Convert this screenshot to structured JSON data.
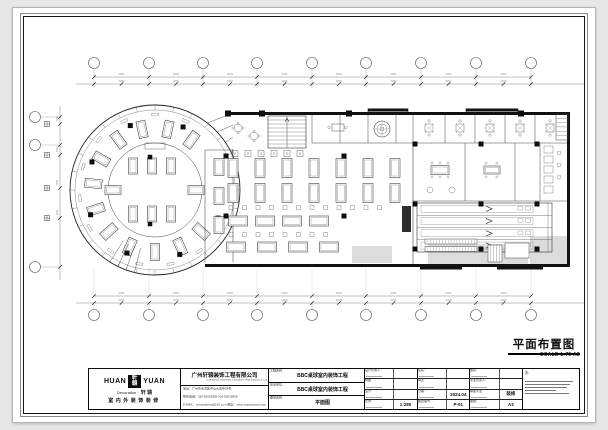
{
  "sheet": {
    "drawing_title": "平面布置图",
    "scale_note": "SCALE 1:75 A2"
  },
  "title_block": {
    "logo": {
      "huan": "HUAN",
      "yuan": "YUAN",
      "seal_top": "軒",
      "seal_bottom": "轅",
      "subtitle_en": "Decoration ·",
      "subtitle_cn": "轩 辕",
      "tagline": "室内外装饰装修"
    },
    "company": {
      "name_cn": "广州轩辕装饰工程有限公司",
      "name_en": "Guangzhou Xuanyuan Decoration Engineering Co.,Ltd",
      "address": "地址：广州市天河区中山大道中38号",
      "phone": "联系电话：020-82018555  020-82018556",
      "email": "E-MAIL：xuanyuanzs@163.com  网址：www.xuanyuanzs.com"
    },
    "project": {
      "rows": [
        {
          "label": "工程名称:",
          "value": "BBC桌球室内装饰工程"
        },
        {
          "label": "建设单位:",
          "value": "BBC桌球室内装饰工程"
        },
        {
          "label": "图纸名称:",
          "value": "平面图"
        }
      ]
    },
    "fields": {
      "columns": [
        {
          "rows": [
            {
              "label": "设计负责人:",
              "value": ""
            },
            {
              "label": "制图:",
              "value": ""
            },
            {
              "label": "设计:",
              "value": ""
            },
            {
              "label": "比例:",
              "value": "1:280"
            }
          ]
        },
        {
          "rows": [
            {
              "label": "签名:",
              "value": ""
            },
            {
              "label": "审定:",
              "value": ""
            },
            {
              "label": "日期:",
              "value": "2024.04"
            },
            {
              "label": "图纸编号:",
              "value": "P-01"
            }
          ]
        },
        {
          "rows": [
            {
              "label": "图别:",
              "value": ""
            },
            {
              "label": "专业负责人:",
              "value": ""
            },
            {
              "label": "审图专业:",
              "value": "装修"
            },
            {
              "label": "图幅:",
              "value": "A3"
            }
          ]
        }
      ]
    },
    "notes_label": "注:"
  }
}
